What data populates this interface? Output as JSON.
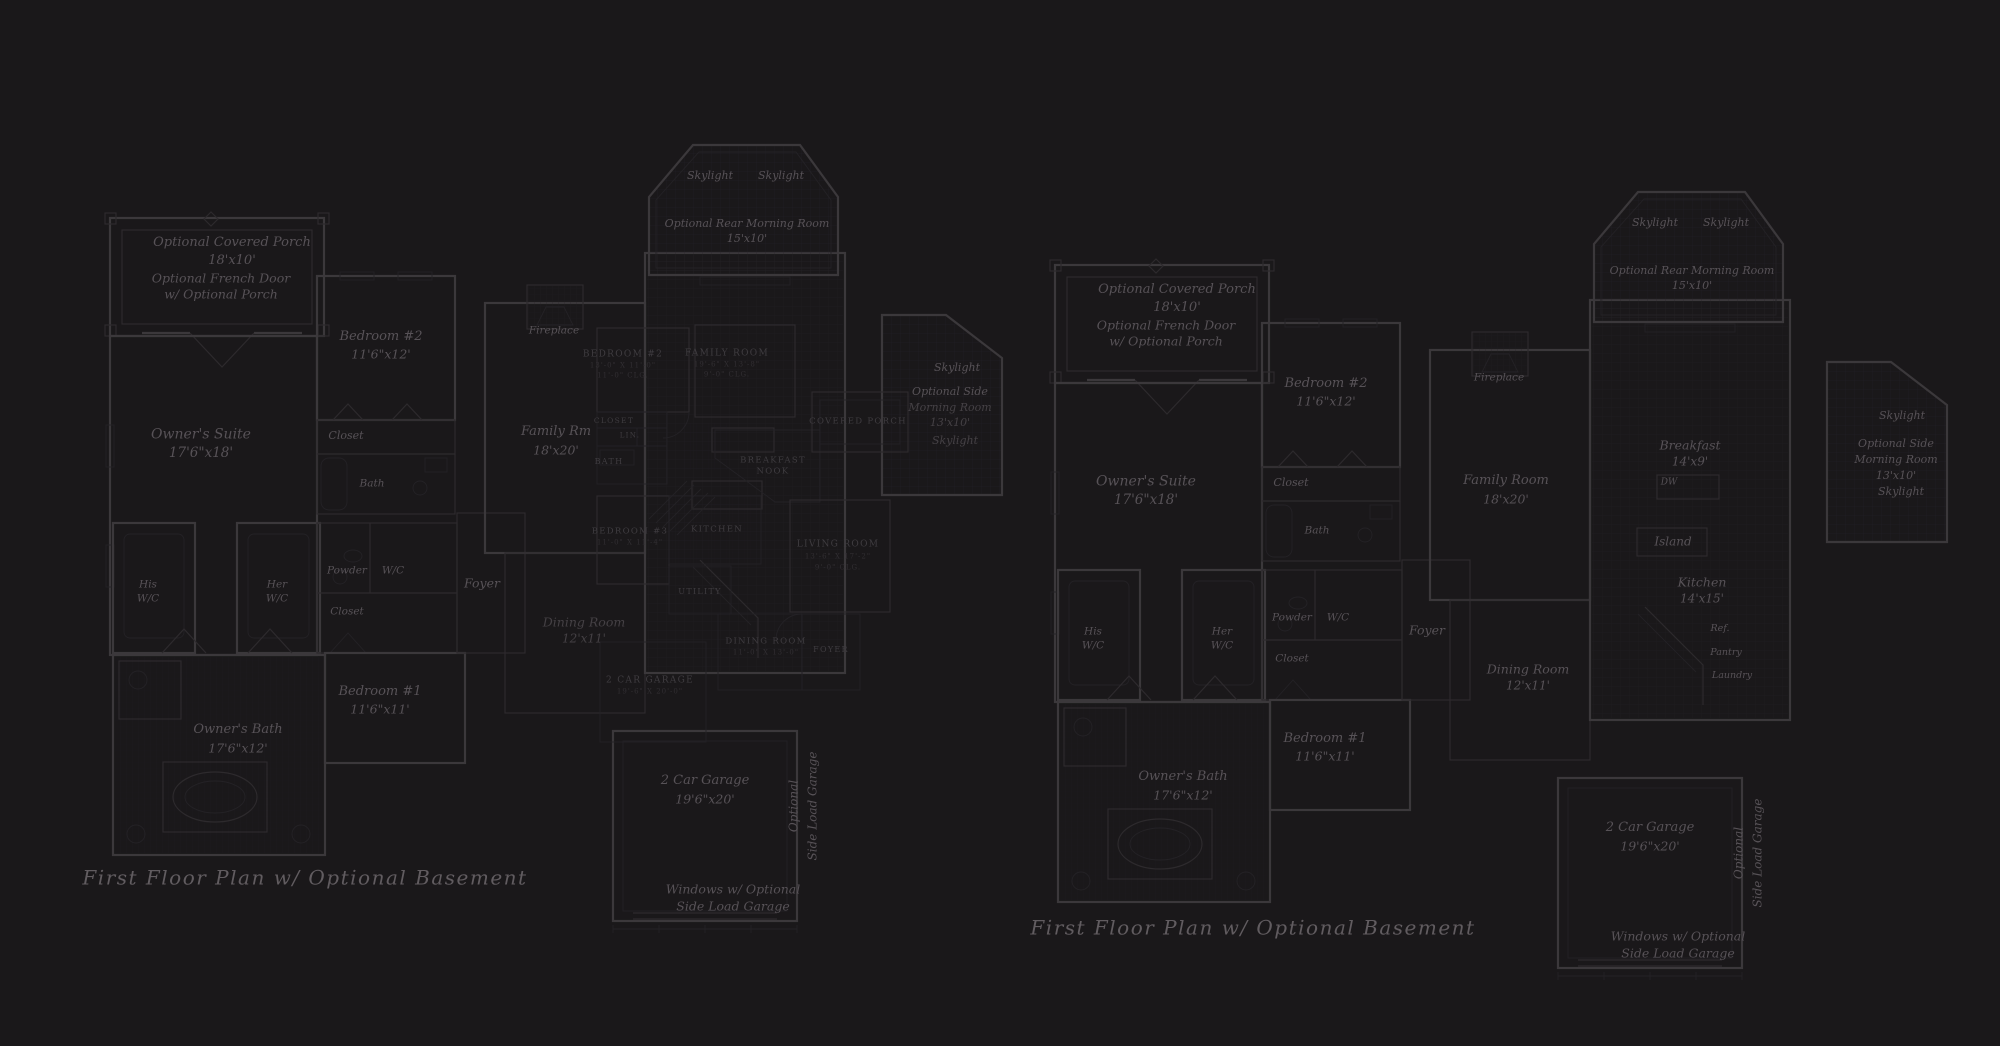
{
  "colors": {
    "bg": "#1a181a",
    "wall": "#3b383b",
    "thin": "#2d2a2d",
    "faint": "#242226",
    "grid": "#232127",
    "textItalic": "#575257",
    "textCaps": "#3f3c40",
    "textDim": "#312e32",
    "textTitle": "#615c60"
  },
  "labels": [
    {
      "t": "Optional Covered Porch",
      "x": 232,
      "y": 243,
      "s": 13,
      "n": "left-porch-label"
    },
    {
      "t": "18'x10'",
      "x": 232,
      "y": 261,
      "s": 13
    },
    {
      "t": "Optional French Door",
      "x": 221,
      "y": 278,
      "s": 12.5,
      "n": "left-french-door-label"
    },
    {
      "t": "w/ Optional Porch",
      "x": 221,
      "y": 294,
      "s": 12.5
    },
    {
      "t": "Owner's Suite",
      "x": 201,
      "y": 435,
      "s": 14,
      "n": "left-owners-suite-label"
    },
    {
      "t": "17'6\"x18'",
      "x": 201,
      "y": 453,
      "s": 13.5
    },
    {
      "t": "Bedroom #2",
      "x": 381,
      "y": 337,
      "s": 13,
      "n": "left-bedroom-2-label"
    },
    {
      "t": "11'6\"x12'",
      "x": 381,
      "y": 354,
      "s": 12.5
    },
    {
      "t": "Closet",
      "x": 346,
      "y": 436,
      "s": 11
    },
    {
      "t": "Bath",
      "x": 372,
      "y": 484,
      "s": 10.5
    },
    {
      "t": "His",
      "x": 148,
      "y": 585,
      "s": 10.5
    },
    {
      "t": "W/C",
      "x": 148,
      "y": 599,
      "s": 10.5
    },
    {
      "t": "Her",
      "x": 277,
      "y": 585,
      "s": 10.5
    },
    {
      "t": "W/C",
      "x": 277,
      "y": 599,
      "s": 10.5
    },
    {
      "t": "Powder",
      "x": 347,
      "y": 571,
      "s": 10.5
    },
    {
      "t": "W/C",
      "x": 393,
      "y": 571,
      "s": 10.5
    },
    {
      "t": "Closet",
      "x": 347,
      "y": 612,
      "s": 10.5
    },
    {
      "t": "Foyer",
      "x": 482,
      "y": 583,
      "s": 12.5,
      "n": "left-foyer-label"
    },
    {
      "t": "Family Rm",
      "x": 556,
      "y": 432,
      "s": 13,
      "n": "left-family-room-label"
    },
    {
      "t": "18'x20'",
      "x": 556,
      "y": 450,
      "s": 12.5
    },
    {
      "t": "Fireplace",
      "x": 554,
      "y": 331,
      "s": 10.5
    },
    {
      "t": "Skylight",
      "x": 710,
      "y": 176,
      "s": 11
    },
    {
      "t": "Skylight",
      "x": 781,
      "y": 176,
      "s": 11
    },
    {
      "t": "Optional Rear Morning Room",
      "x": 747,
      "y": 224,
      "s": 11,
      "n": "left-rear-morning-room-label"
    },
    {
      "t": "15'x10'",
      "x": 747,
      "y": 239,
      "s": 11
    },
    {
      "t": "Skylight",
      "x": 957,
      "y": 368,
      "s": 11
    },
    {
      "t": "Optional Side",
      "x": 950,
      "y": 392,
      "s": 11,
      "n": "left-side-morning-room-label"
    },
    {
      "t": "Morning Room",
      "x": 950,
      "y": 408,
      "s": 11,
      "o": 0.7
    },
    {
      "t": "13'x10'",
      "x": 950,
      "y": 423,
      "s": 11,
      "o": 0.7
    },
    {
      "t": "Skylight",
      "x": 955,
      "y": 441,
      "s": 11,
      "o": 0.7
    },
    {
      "t": "Dining Room",
      "x": 584,
      "y": 622,
      "s": 12.5,
      "o": 0.7,
      "n": "left-dining-room-label"
    },
    {
      "t": "12'x11'",
      "x": 584,
      "y": 639,
      "s": 12,
      "o": 0.7
    },
    {
      "t": "Bedroom #1",
      "x": 380,
      "y": 692,
      "s": 13,
      "n": "left-bedroom-1-label"
    },
    {
      "t": "11'6\"x11'",
      "x": 380,
      "y": 709,
      "s": 12.5
    },
    {
      "t": "Owner's Bath",
      "x": 238,
      "y": 730,
      "s": 13,
      "n": "left-owners-bath-label"
    },
    {
      "t": "17'6\"x12'",
      "x": 238,
      "y": 748,
      "s": 12.5
    },
    {
      "t": "2 Car Garage",
      "x": 705,
      "y": 781,
      "s": 13,
      "n": "left-garage-label"
    },
    {
      "t": "19'6\"x20'",
      "x": 705,
      "y": 799,
      "s": 12.5
    },
    {
      "t": "Optional",
      "x": 794,
      "y": 806,
      "s": 12,
      "r": -90
    },
    {
      "t": "Side Load Garage",
      "x": 813,
      "y": 806,
      "s": 12,
      "r": -90
    },
    {
      "t": "Windows w/ Optional",
      "x": 733,
      "y": 889,
      "s": 12.5
    },
    {
      "t": "Side Load Garage",
      "x": 733,
      "y": 906,
      "s": 12.5
    },
    {
      "t": "First Floor Plan  w/ Optional Basement",
      "x": 305,
      "y": 878,
      "s": 20,
      "c": "title",
      "n": "left-plan-title"
    },
    {
      "t": "BEDROOM #2",
      "x": 623,
      "y": 355,
      "s": 9,
      "c": "caps"
    },
    {
      "t": "13'-0\" X 11'-0\"",
      "x": 623,
      "y": 366,
      "s": 7,
      "c": "capsd"
    },
    {
      "t": "11'-0\" CLG.",
      "x": 623,
      "y": 376,
      "s": 7,
      "c": "capsd"
    },
    {
      "t": "FAMILY ROOM",
      "x": 727,
      "y": 354,
      "s": 9,
      "c": "caps"
    },
    {
      "t": "19'-6\" X 13'-8\"",
      "x": 727,
      "y": 365,
      "s": 7,
      "c": "capsd"
    },
    {
      "t": "9'-0\" CLG.",
      "x": 727,
      "y": 375,
      "s": 7,
      "c": "capsd"
    },
    {
      "t": "CLOSET",
      "x": 614,
      "y": 421,
      "s": 7.5,
      "c": "caps"
    },
    {
      "t": "LIN.",
      "x": 630,
      "y": 436,
      "s": 7,
      "c": "caps"
    },
    {
      "t": "BATH",
      "x": 609,
      "y": 462,
      "s": 8,
      "c": "caps"
    },
    {
      "t": "BREAKFAST",
      "x": 773,
      "y": 461,
      "s": 8.5,
      "c": "caps"
    },
    {
      "t": "NOOK",
      "x": 773,
      "y": 472,
      "s": 8.5,
      "c": "caps"
    },
    {
      "t": "KITCHEN",
      "x": 717,
      "y": 530,
      "s": 8.5,
      "c": "caps"
    },
    {
      "t": "BEDROOM #3",
      "x": 630,
      "y": 532,
      "s": 8.5,
      "c": "caps"
    },
    {
      "t": "11'-0\" X 11'-4\"",
      "x": 630,
      "y": 543,
      "s": 7,
      "c": "capsd"
    },
    {
      "t": "UTILITY",
      "x": 700,
      "y": 592,
      "s": 8,
      "c": "caps"
    },
    {
      "t": "LIVING ROOM",
      "x": 838,
      "y": 545,
      "s": 9,
      "c": "caps"
    },
    {
      "t": "13'-6\" X 17'-2\"",
      "x": 838,
      "y": 557,
      "s": 7,
      "c": "capsd"
    },
    {
      "t": "9'-0\" CLG.",
      "x": 838,
      "y": 568,
      "s": 7,
      "c": "capsd"
    },
    {
      "t": "DINING ROOM",
      "x": 766,
      "y": 642,
      "s": 8.5,
      "c": "caps"
    },
    {
      "t": "11'-0\" X 13'-0\"",
      "x": 766,
      "y": 653,
      "s": 7,
      "c": "capsd"
    },
    {
      "t": "FOYER",
      "x": 831,
      "y": 650,
      "s": 8,
      "c": "caps"
    },
    {
      "t": "COVERED PORCH",
      "x": 858,
      "y": 422,
      "s": 8.5,
      "c": "caps"
    },
    {
      "t": "2 CAR GARAGE",
      "x": 650,
      "y": 681,
      "s": 9,
      "c": "caps"
    },
    {
      "t": "19'-6\" X 20'-0\"",
      "x": 650,
      "y": 692,
      "s": 7,
      "c": "capsd"
    },
    {
      "t": "Optional Covered Porch",
      "x": 1177,
      "y": 290,
      "s": 13,
      "n": "right-porch-label"
    },
    {
      "t": "18'x10'",
      "x": 1177,
      "y": 308,
      "s": 13
    },
    {
      "t": "Optional French Door",
      "x": 1166,
      "y": 325,
      "s": 12.5,
      "n": "right-french-door-label"
    },
    {
      "t": "w/ Optional Porch",
      "x": 1166,
      "y": 341,
      "s": 12.5
    },
    {
      "t": "Owner's Suite",
      "x": 1146,
      "y": 482,
      "s": 14,
      "n": "right-owners-suite-label"
    },
    {
      "t": "17'6\"x18'",
      "x": 1146,
      "y": 500,
      "s": 13.5
    },
    {
      "t": "Bedroom #2",
      "x": 1326,
      "y": 384,
      "s": 13,
      "n": "right-bedroom-2-label"
    },
    {
      "t": "11'6\"x12'",
      "x": 1326,
      "y": 401,
      "s": 12.5
    },
    {
      "t": "Closet",
      "x": 1291,
      "y": 483,
      "s": 11
    },
    {
      "t": "Bath",
      "x": 1317,
      "y": 531,
      "s": 10.5
    },
    {
      "t": "His",
      "x": 1093,
      "y": 632,
      "s": 10.5
    },
    {
      "t": "W/C",
      "x": 1093,
      "y": 646,
      "s": 10.5
    },
    {
      "t": "Her",
      "x": 1222,
      "y": 632,
      "s": 10.5
    },
    {
      "t": "W/C",
      "x": 1222,
      "y": 646,
      "s": 10.5
    },
    {
      "t": "Powder",
      "x": 1292,
      "y": 618,
      "s": 10.5
    },
    {
      "t": "W/C",
      "x": 1338,
      "y": 618,
      "s": 10.5
    },
    {
      "t": "Closet",
      "x": 1292,
      "y": 659,
      "s": 10.5
    },
    {
      "t": "Foyer",
      "x": 1427,
      "y": 630,
      "s": 12.5,
      "n": "right-foyer-label"
    },
    {
      "t": "Family Room",
      "x": 1506,
      "y": 481,
      "s": 13,
      "n": "right-family-room-label"
    },
    {
      "t": "18'x20'",
      "x": 1506,
      "y": 499,
      "s": 12.5
    },
    {
      "t": "Fireplace",
      "x": 1499,
      "y": 378,
      "s": 10.5
    },
    {
      "t": "Skylight",
      "x": 1655,
      "y": 223,
      "s": 11
    },
    {
      "t": "Skylight",
      "x": 1726,
      "y": 223,
      "s": 11
    },
    {
      "t": "Optional Rear Morning Room",
      "x": 1692,
      "y": 271,
      "s": 11,
      "n": "right-rear-morning-room-label"
    },
    {
      "t": "15'x10'",
      "x": 1692,
      "y": 286,
      "s": 11
    },
    {
      "t": "Breakfast",
      "x": 1690,
      "y": 445,
      "s": 12.5,
      "n": "right-breakfast-label"
    },
    {
      "t": "14'x9'",
      "x": 1690,
      "y": 462,
      "s": 12
    },
    {
      "t": "DW",
      "x": 1669,
      "y": 483,
      "s": 9
    },
    {
      "t": "Island",
      "x": 1673,
      "y": 542,
      "s": 12,
      "n": "right-island-label"
    },
    {
      "t": "Kitchen",
      "x": 1702,
      "y": 582,
      "s": 12.5,
      "n": "right-kitchen-label"
    },
    {
      "t": "14'x15'",
      "x": 1702,
      "y": 599,
      "s": 12
    },
    {
      "t": "Ref.",
      "x": 1720,
      "y": 629,
      "s": 9.5
    },
    {
      "t": "Pantry",
      "x": 1726,
      "y": 653,
      "s": 9.5
    },
    {
      "t": "Laundry",
      "x": 1732,
      "y": 676,
      "s": 9.5
    },
    {
      "t": "Dining Room",
      "x": 1528,
      "y": 669,
      "s": 12.5,
      "n": "right-dining-room-label"
    },
    {
      "t": "12'x11'",
      "x": 1528,
      "y": 686,
      "s": 12
    },
    {
      "t": "Bedroom #1",
      "x": 1325,
      "y": 739,
      "s": 13,
      "n": "right-bedroom-1-label"
    },
    {
      "t": "11'6\"x11'",
      "x": 1325,
      "y": 756,
      "s": 12.5
    },
    {
      "t": "Owner's Bath",
      "x": 1183,
      "y": 777,
      "s": 13,
      "n": "right-owners-bath-label"
    },
    {
      "t": "17'6\"x12'",
      "x": 1183,
      "y": 795,
      "s": 12.5
    },
    {
      "t": "Skylight",
      "x": 1902,
      "y": 416,
      "s": 11
    },
    {
      "t": "Optional Side",
      "x": 1896,
      "y": 444,
      "s": 11,
      "n": "right-side-morning-room-label"
    },
    {
      "t": "Morning Room",
      "x": 1896,
      "y": 460,
      "s": 11
    },
    {
      "t": "13'x10'",
      "x": 1896,
      "y": 476,
      "s": 11
    },
    {
      "t": "Skylight",
      "x": 1901,
      "y": 492,
      "s": 11
    },
    {
      "t": "2 Car Garage",
      "x": 1650,
      "y": 828,
      "s": 13,
      "n": "right-garage-label"
    },
    {
      "t": "19'6\"x20'",
      "x": 1650,
      "y": 846,
      "s": 12.5
    },
    {
      "t": "Optional",
      "x": 1739,
      "y": 853,
      "s": 12,
      "r": -90
    },
    {
      "t": "Side Load Garage",
      "x": 1758,
      "y": 853,
      "s": 12,
      "r": -90
    },
    {
      "t": "Windows w/ Optional",
      "x": 1678,
      "y": 936,
      "s": 12.5
    },
    {
      "t": "Side Load Garage",
      "x": 1678,
      "y": 953,
      "s": 12.5
    },
    {
      "t": "First Floor Plan  w/ Optional Basement",
      "x": 1253,
      "y": 928,
      "s": 20,
      "c": "title",
      "n": "right-plan-title"
    }
  ]
}
